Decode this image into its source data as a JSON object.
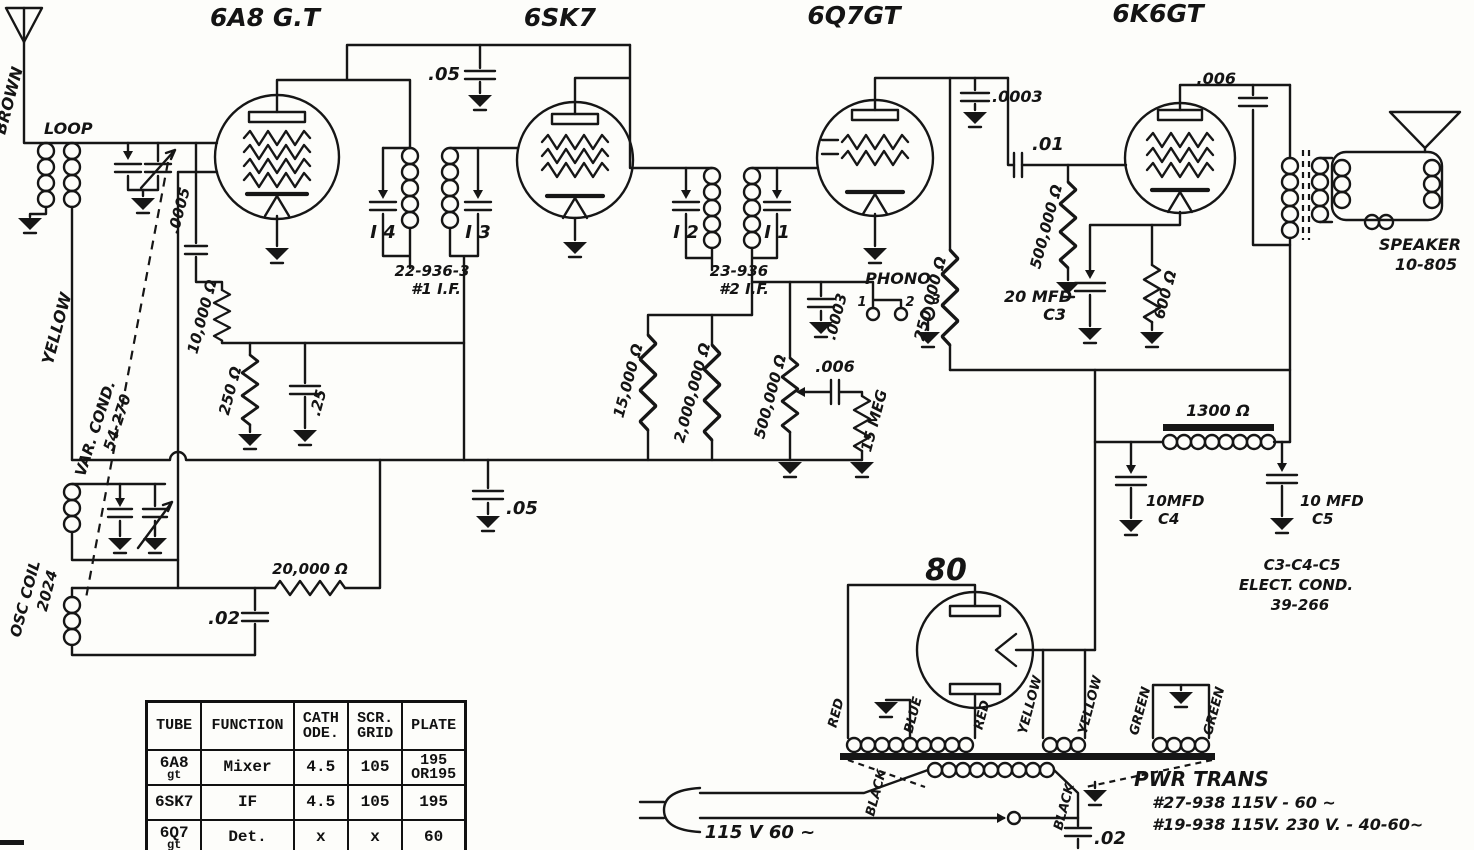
{
  "colors": {
    "ink": "#161616",
    "paper": "#fdfdfa"
  },
  "labels": {
    "tube_6a8": "6A8 G.T",
    "tube_6sk7": "6SK7",
    "tube_6q7": "6Q7GT",
    "tube_6k6": "6K6GT",
    "tube_80": "80",
    "brown": "BROWN",
    "loop": "LOOP",
    "yellow_loop": "YELLOW",
    "var_cond_line1": "VAR. COND.",
    "var_cond_line2": "54-270",
    "osc_coil_line1": "OSC COIL",
    "osc_coil_line2": "2024",
    "c_0005": ".0005",
    "r_10k": "10,000 Ω",
    "r_250": "250 Ω",
    "c_25": ".25",
    "c_05_top": ".05",
    "c_05_mid": ".05",
    "trim_i4": "I 4",
    "trim_i3": "I 3",
    "trim_i2": "I 2",
    "trim_i1": "I 1",
    "if1_line1": "22-936-3",
    "if1_line2": "#1 I.F.",
    "if2_line1": "23-936",
    "if2_line2": "#2 I.F.",
    "r_20k": "20,000 Ω",
    "c_02_osc": ".02",
    "r_15k": "15,000 Ω",
    "r_2meg": "2,000,000 Ω",
    "c_0003_plate": ".0003",
    "c_0003_phono": ".0003",
    "phono": "PHONO",
    "jack_1": "1",
    "jack_2": "2",
    "jack_3": "3",
    "r_500k_vol": "500,000 Ω",
    "c_006_audio": ".006",
    "r_15meg": "15 MEG",
    "r_250k": "250,000 Ω",
    "c_01": ".01",
    "r_500k_grid": "500,000 Ω",
    "c_20mfd": "20 MFD",
    "c_20mfd_name": "C3",
    "r_600": "600 Ω",
    "c_006_plate": ".006",
    "speaker_line1": "SPEAKER",
    "speaker_line2": "10-805",
    "r_1300": "1300 Ω",
    "c4_value": "10MFD",
    "c4_name": "C4",
    "c5_value": "10 MFD",
    "c5_name": "C5",
    "elect_line1": "C3-C4-C5",
    "elect_line2": "ELECT.  COND.",
    "elect_line3": "39-266",
    "xfmr_red_1": "RED",
    "xfmr_blue": "BLUE",
    "xfmr_red_2": "RED",
    "xfmr_yellow_1": "YELLOW",
    "xfmr_yellow_2": "YELLOW",
    "xfmr_green_1": "GREEN",
    "xfmr_green_2": "GREEN",
    "xfmr_black_1": "BLACK",
    "xfmr_black_2": "BLACK",
    "pwr_line1": "PWR  TRANS",
    "pwr_line2": "#27-938    115V - 60 ~",
    "pwr_line3": "#19-938    115V. 230 V.  -  40-60~",
    "ac_line": "115 V   60 ~",
    "c_02_line": ".02"
  },
  "table": {
    "headers": [
      {
        "l1": "TUBE"
      },
      {
        "l1": "FUNCTION"
      },
      {
        "l1": "CATH",
        "l2": "ODE."
      },
      {
        "l1": "SCR.",
        "l2": "GRID"
      },
      {
        "l1": "PLATE"
      }
    ],
    "rows": [
      {
        "tube1": "6A8",
        "tube2": "gt",
        "func": "Mixer",
        "cath": "4.5",
        "scr": "105",
        "plate1": "195",
        "plate2": "OR195"
      },
      {
        "tube1": "6SK7",
        "tube2": "",
        "func": "IF",
        "cath": "4.5",
        "scr": "105",
        "plate1": "195",
        "plate2": ""
      },
      {
        "tube1": "6Q7",
        "tube2": "gt",
        "func": "Det.",
        "cath": "x",
        "scr": "x",
        "plate1": "60",
        "plate2": ""
      }
    ]
  }
}
